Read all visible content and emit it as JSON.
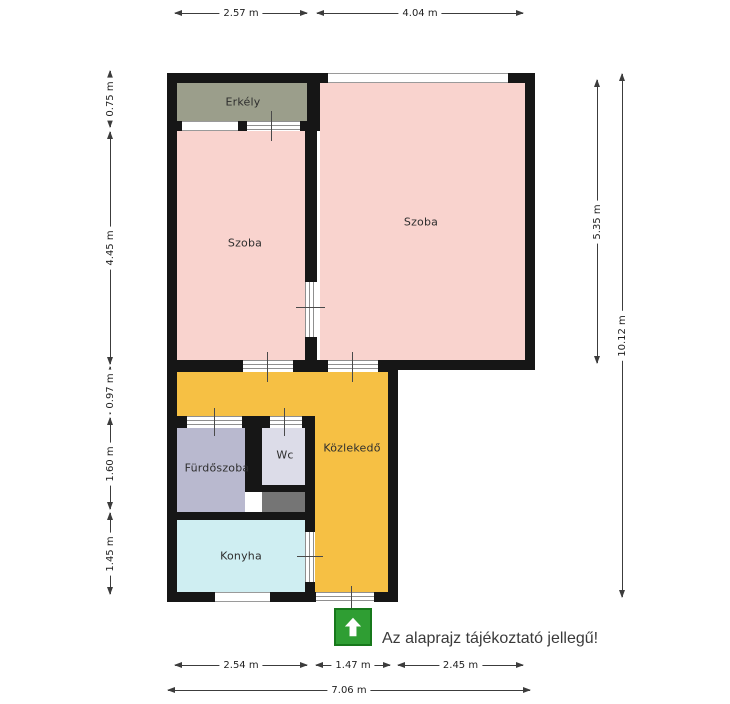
{
  "floorplan": {
    "rooms": [
      {
        "label": "Erkély",
        "color_key": "balcony"
      },
      {
        "label": "Szoba",
        "color_key": "room"
      },
      {
        "label": "Szoba",
        "color_key": "room"
      },
      {
        "label": "Fürdőszoba",
        "color_key": "bathroom"
      },
      {
        "label": "Wc",
        "color_key": "wc"
      },
      {
        "label": "Közlekedő",
        "color_key": "corridor"
      },
      {
        "label": "Konyha",
        "color_key": "kitchen"
      }
    ],
    "disclaimer": "Az alaprajz tájékoztató jellegű!"
  },
  "dims": {
    "top": [
      {
        "label": "2.57 m"
      },
      {
        "label": "4.04 m"
      }
    ],
    "left": [
      {
        "label": "0.75 m"
      },
      {
        "label": "4.45 m"
      },
      {
        "label": "0.97 m"
      },
      {
        "label": "1.60 m"
      },
      {
        "label": "1.45 m"
      }
    ],
    "right": [
      {
        "label": "5.35 m"
      },
      {
        "label": "10.12 m"
      }
    ],
    "bottom": [
      {
        "label": "2.54 m"
      },
      {
        "label": "1.47 m"
      },
      {
        "label": "2.45 m"
      },
      {
        "label": "7.06 m"
      }
    ]
  },
  "colors": {
    "room": "#f9d3ce",
    "balcony": "#9b9e8b",
    "bathroom": "#b9b9cf",
    "wc": "#dcdce8",
    "kitchen": "#cfeef2",
    "corridor": "#f6c044",
    "shaft": "#757575",
    "entrance_green": "#2f9e33"
  },
  "icons": {
    "entrance_arrow": "up-arrow"
  }
}
